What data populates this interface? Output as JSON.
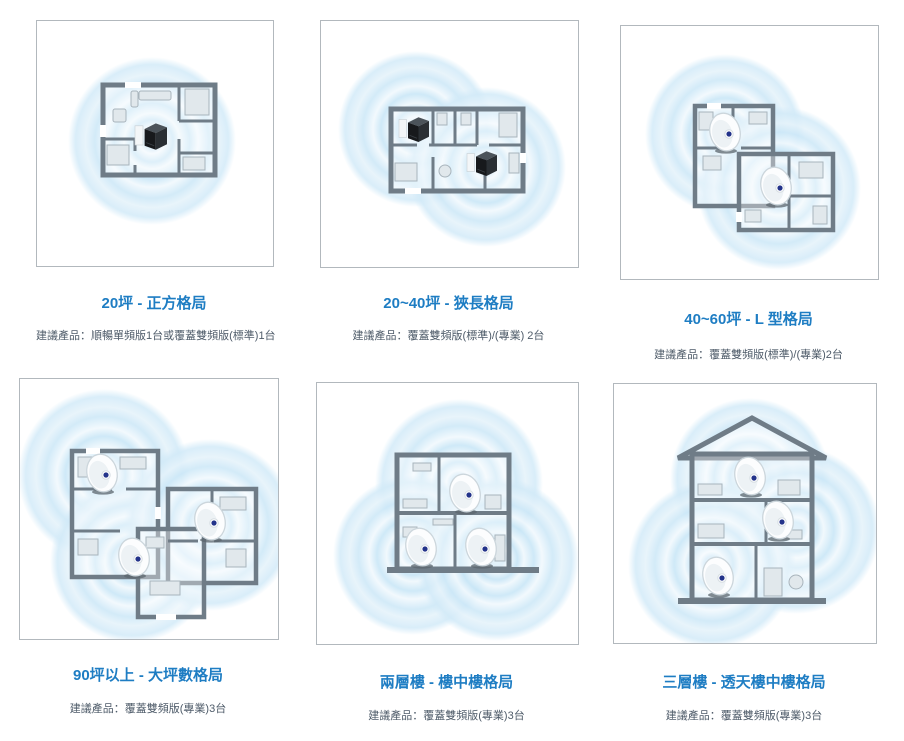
{
  "page": {
    "background": "#ffffff",
    "title_color": "#1e7dc3",
    "subtitle_color": "#4e5b69",
    "panel_border_color": "#b2b8bd",
    "wifi_color": "#c8e6f7",
    "wall_color": "#6f7c87"
  },
  "panels": [
    {
      "id": "square-20ping",
      "title": "20坪 - 正方格局",
      "subtitle": "建議產品：順暢單頻版1台或覆蓋雙頻版(標準)1台",
      "layout": "square",
      "device_type": "cube-router",
      "device_count": 1,
      "coverage_zones": 1
    },
    {
      "id": "narrow-20-40ping",
      "title": "20~40坪 - 狹長格局",
      "subtitle": "建議產品：覆蓋雙頻版(標準)/(專業) 2台",
      "layout": "narrow-rectangle",
      "device_type": "cube-router",
      "device_count": 2,
      "coverage_zones": 2
    },
    {
      "id": "l-shape-40-60ping",
      "title": "40~60坪 -  L 型格局",
      "subtitle": "建議產品：覆蓋雙頻版(標準)/(專業)2台",
      "layout": "l-shape",
      "device_type": "mesh-pod",
      "device_count": 2,
      "coverage_zones": 2
    },
    {
      "id": "large-90ping-up",
      "title": "90坪以上 - 大坪數格局",
      "subtitle": "建議產品：覆蓋雙頻版(專業)3台",
      "layout": "large-multi-room",
      "device_type": "mesh-pod",
      "device_count": 3,
      "coverage_zones": 3
    },
    {
      "id": "two-story-loft",
      "title": "兩層樓 - 樓中樓格局",
      "subtitle": "建議產品：覆蓋雙頻版(專業)3台",
      "layout": "two-story-section",
      "device_type": "mesh-pod",
      "device_count": 3,
      "coverage_zones": 3
    },
    {
      "id": "three-story-townhouse",
      "title": "三層樓 - 透天樓中樓格局",
      "subtitle": "建議產品：覆蓋雙頻版(專業)3台",
      "layout": "three-story-section",
      "device_type": "mesh-pod",
      "device_count": 3,
      "coverage_zones": 3
    }
  ]
}
